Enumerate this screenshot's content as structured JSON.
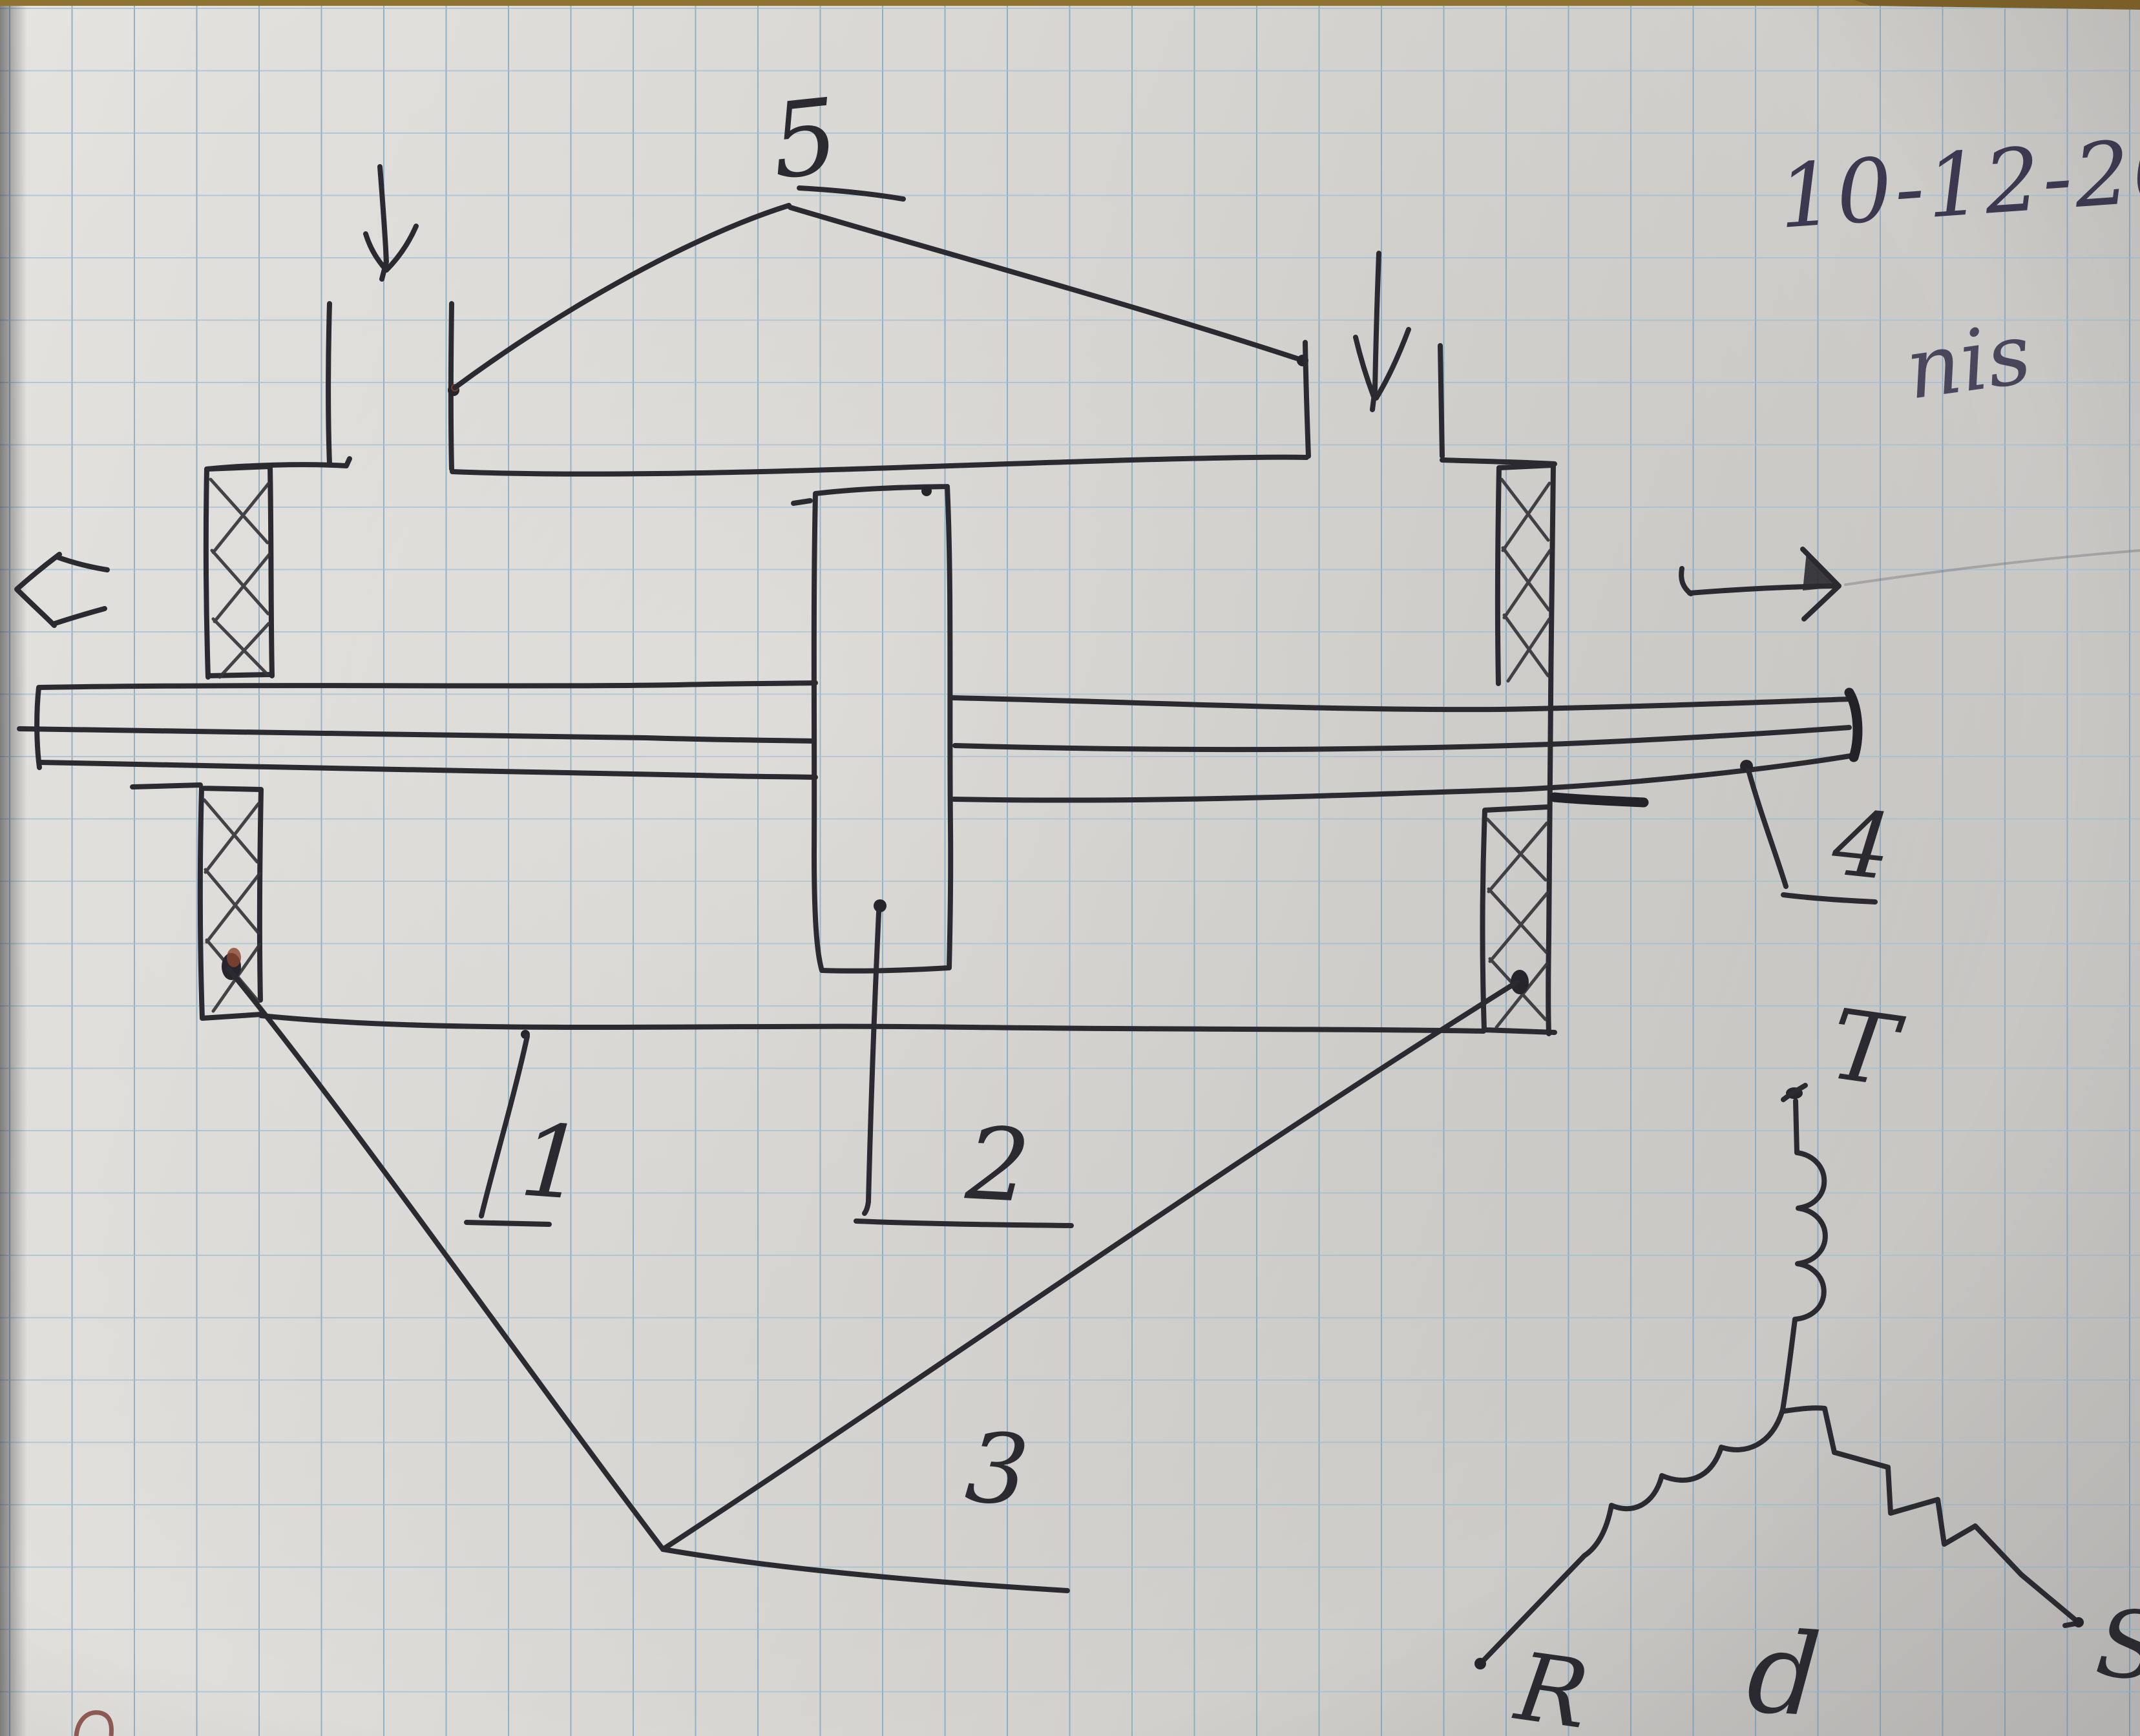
{
  "page": {
    "type": "photographed squared-notebook page with hand-drawn sketch",
    "date_note": "10-12-2023",
    "signature": "nis"
  },
  "diagram": {
    "subject": "axial cross-section sketch of a rotating electrical machine with shaft, bearings and two inlets",
    "part_labels": {
      "p1": "1",
      "p2": "2",
      "p3": "3",
      "p4": "4",
      "p5": "5"
    },
    "icons": {
      "left_inlet_flow": "down-arrow-icon",
      "right_inlet_flow": "down-arrow-icon",
      "shaft_left_motion": "left-arrow-icon",
      "shaft_right_motion": "double-headed-horizontal-arrow-icon",
      "bearing_fill": "cross-hatch-pattern"
    }
  },
  "circuit": {
    "type": "three-phase wye (star) winding sketch",
    "phase_top": "T",
    "phase_left": "R",
    "phase_right": "S",
    "center_label": "d"
  },
  "colors": {
    "ink": "#2b2a30",
    "ballpoint_blue": "#3c3850",
    "grid_vertical": "#7fa6c2",
    "grid_horizontal": "#9cc0d4",
    "paper_light": "#e7e5e1",
    "paper_dark": "#cdcac7",
    "rust_blob": "#8a4530",
    "red_corner_mark": "#8c5a52",
    "top_edge_strip": "#8f7330"
  }
}
